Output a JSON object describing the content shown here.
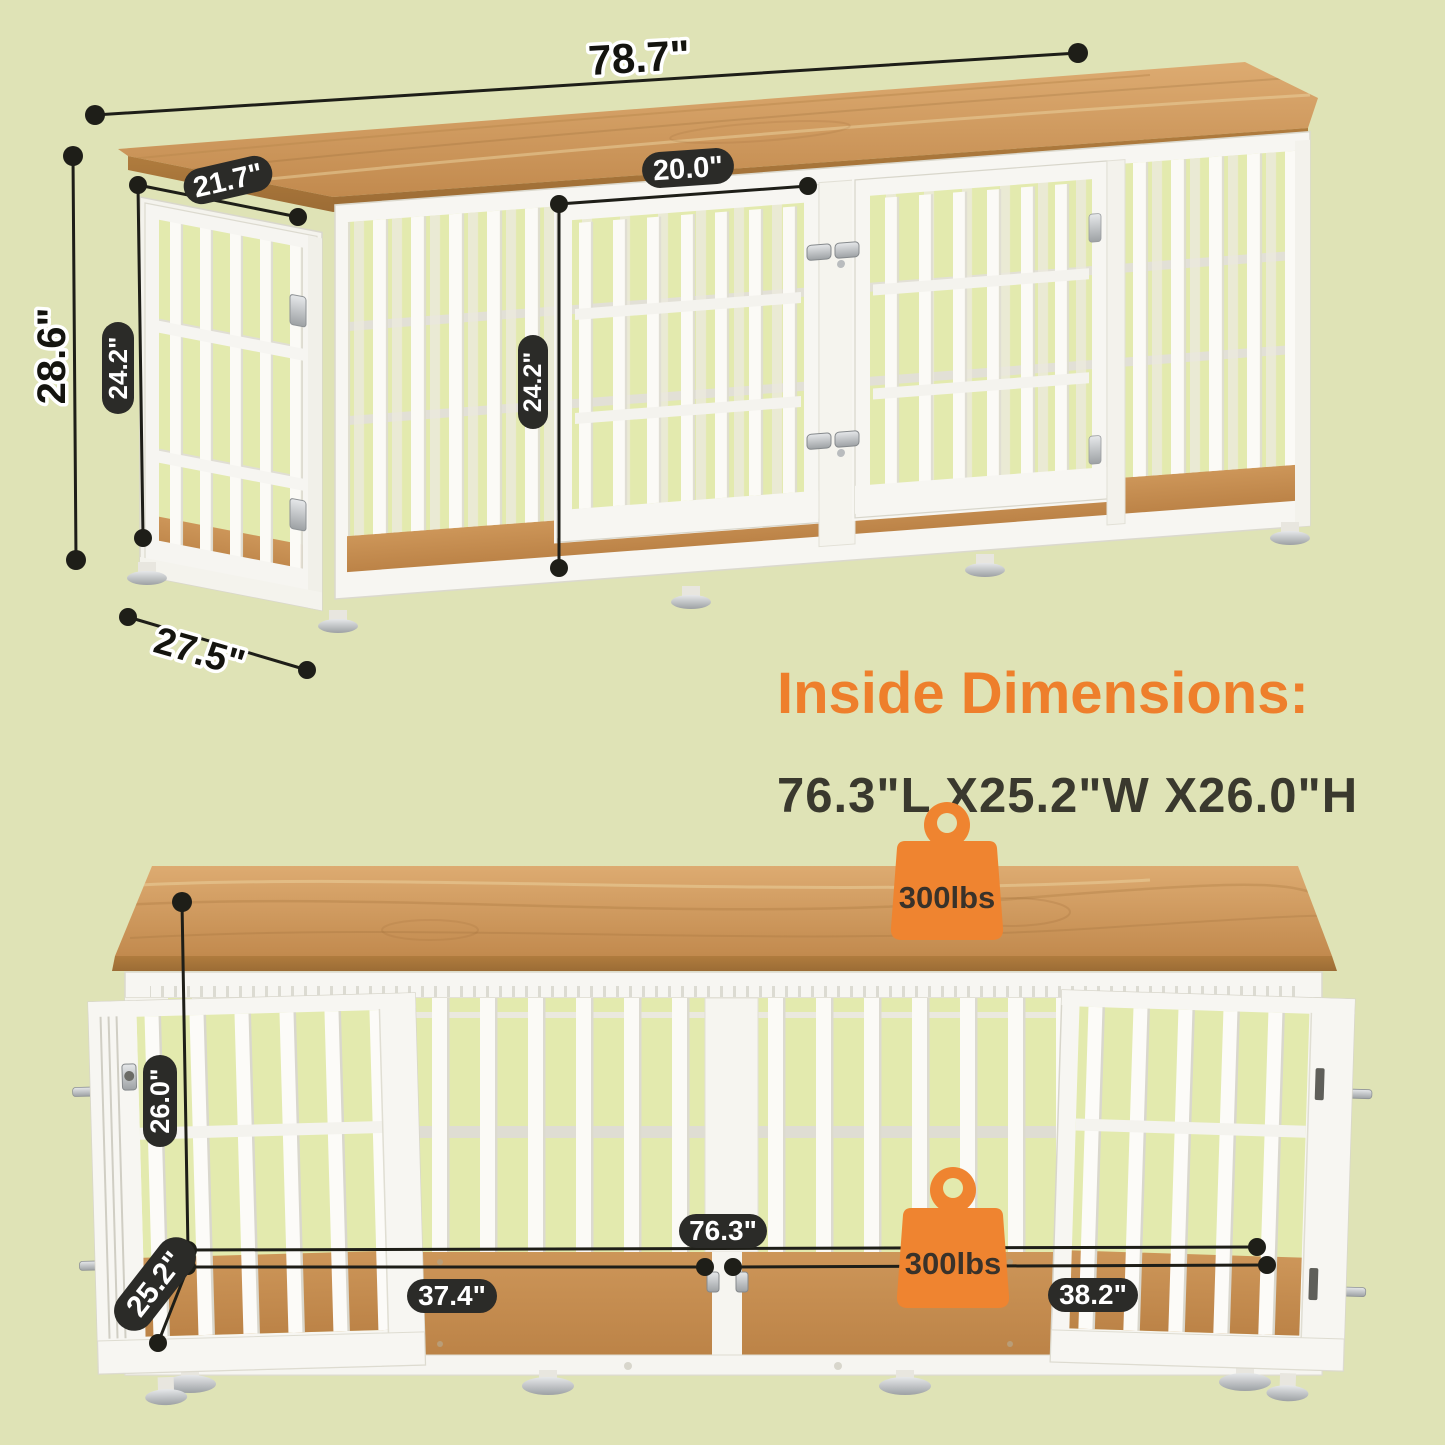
{
  "top_view": {
    "labels": {
      "overall_width": "78.7\"",
      "left_door_width": "21.7\"",
      "middle_door_width": "20.0\"",
      "overall_height": "28.6\"",
      "left_door_height": "24.2\"",
      "middle_door_height": "24.2\"",
      "base_depth": "27.5\""
    }
  },
  "inside_dimensions": {
    "heading": "Inside Dimensions:",
    "value": "76.3\"L X25.2\"W X26.0\"H"
  },
  "bottom_view": {
    "labels": {
      "inner_height": "26.0\"",
      "inner_depth": "25.2\"",
      "inner_width": "76.3\"",
      "left_compartment_width": "37.4\"",
      "right_compartment_width": "38.2\""
    },
    "weight_top": "300lbs",
    "weight_floor": "300lbs"
  },
  "colors": {
    "background": "#dfe3b6",
    "accent_orange": "#ef8430",
    "pill_black": "#2b2b28",
    "wood": "#cf9a5e",
    "frame_white": "#f7f6f2"
  }
}
